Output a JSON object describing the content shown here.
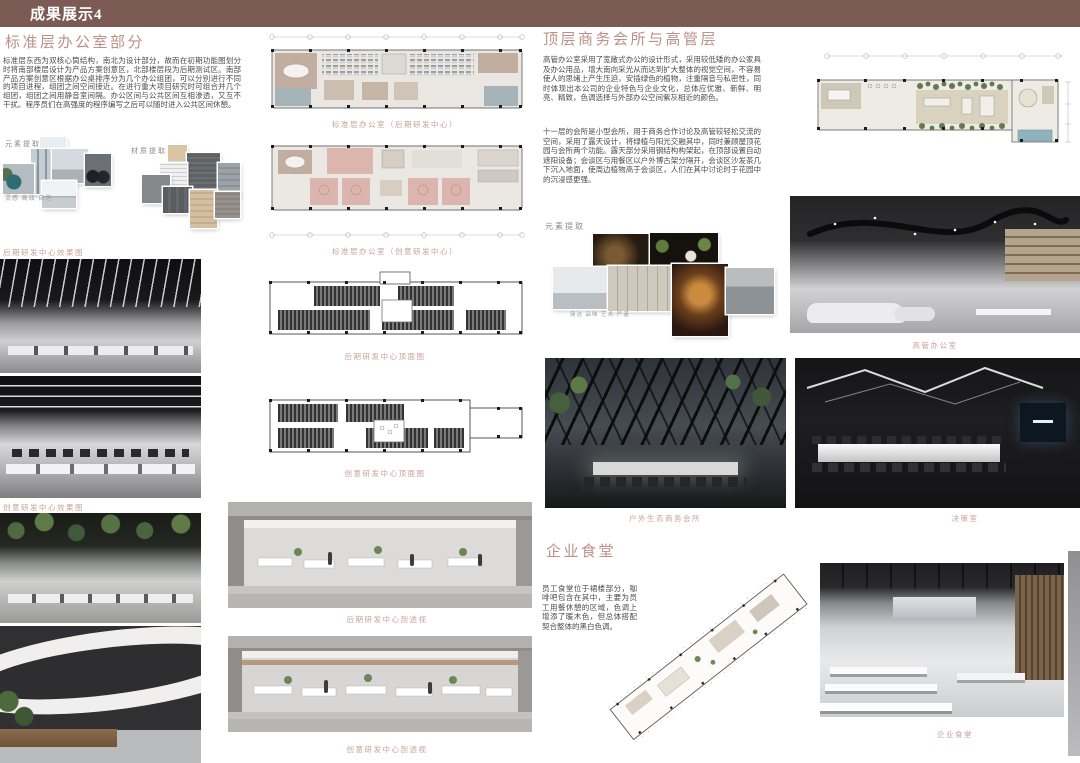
{
  "header": {
    "title": "成果展示4"
  },
  "colors": {
    "top_bar": "#7d5b55",
    "heading_pink": "#bd908a",
    "caption_pink": "#c8a09a"
  },
  "left": {
    "heading": "标准层办公室部分",
    "paragraph": "标准层东西为双核心筒结构，南北为设计部分，故而在初期功能图划分时将南部楼层设计为产品方案创意区，北部楼层段为后期测试区。南部产品方案创意区根据办公桌排序分为几个办公组团，可以分别进行不同的项目进程，组团之间空间接近。在进行重大项目研究时可组合并几个组团，组团之间用静音室间隔。办公区间与公共区间互相渗透，又互不干扰。程序员们在高强度的程序编写之后可以随时进入公共区间休憩。",
    "element_label": "元素提取",
    "material_label": "材质提取",
    "keywords": "灵感 高效 自信",
    "render1_caption": "后期研发中心效果图",
    "render2_caption": "创意研发中心效果图"
  },
  "plans": {
    "plan1_caption": "标准层办公室（后期研发中心）",
    "plan2_caption": "标准层办公室（创意研发中心）",
    "ceiling1_caption": "后期研发中心顶面图",
    "ceiling2_caption": "创意研发中心顶面图",
    "section1_caption": "后期研发中心剖透视",
    "section2_caption": "创意研发中心剖透视"
  },
  "right": {
    "heading": "顶层商务会所与高管层",
    "paragraph1": "高管办公室采用了宽敞式办公的设计形式，采用较低矮的办公家具及办公用品，增大南向采光从而达到扩大整体的视觉空间，不容易使人的思绪上产生压迫，安插绿色的植物，注重隔音与私密性，同时体现出本公司的企业特色与企业文化，总体应优雅、新鲜、明亮、精致，色调选择与外部办公空间紫灰相近的颜色。",
    "paragraph2": "十一层的会所是小型会所，用于商务合作讨论及高管较轻松交流的空间，采用了露天设计，将绿植与阳光交融其中，同时兼顾屋顶花园与会所两个功能。露天部分采用钢结构构架起，在顶部设置自动遮阳设备；会谈区与用餐区以户外博古架分隔开，会谈区沙发茶几下沉入地面，使周边植物高于会谈区，人们在其中讨论时于花园中的沉浸感更强。",
    "element_label": "元素提取",
    "keywords": "简洁 品味 艺术 严谨",
    "exec_caption": "高管办公室",
    "outdoor_caption": "户外生态商务会所",
    "decision_caption": "决策室"
  },
  "canteen": {
    "heading": "企业食堂",
    "paragraph": "员工食堂位于裙楼部分，咖啡吧包含在其中，主要为员工用餐休憩的区域，色调上增添了暖木色，但总体搭配契合整体的黑白色调。",
    "caption": "企业食堂"
  }
}
